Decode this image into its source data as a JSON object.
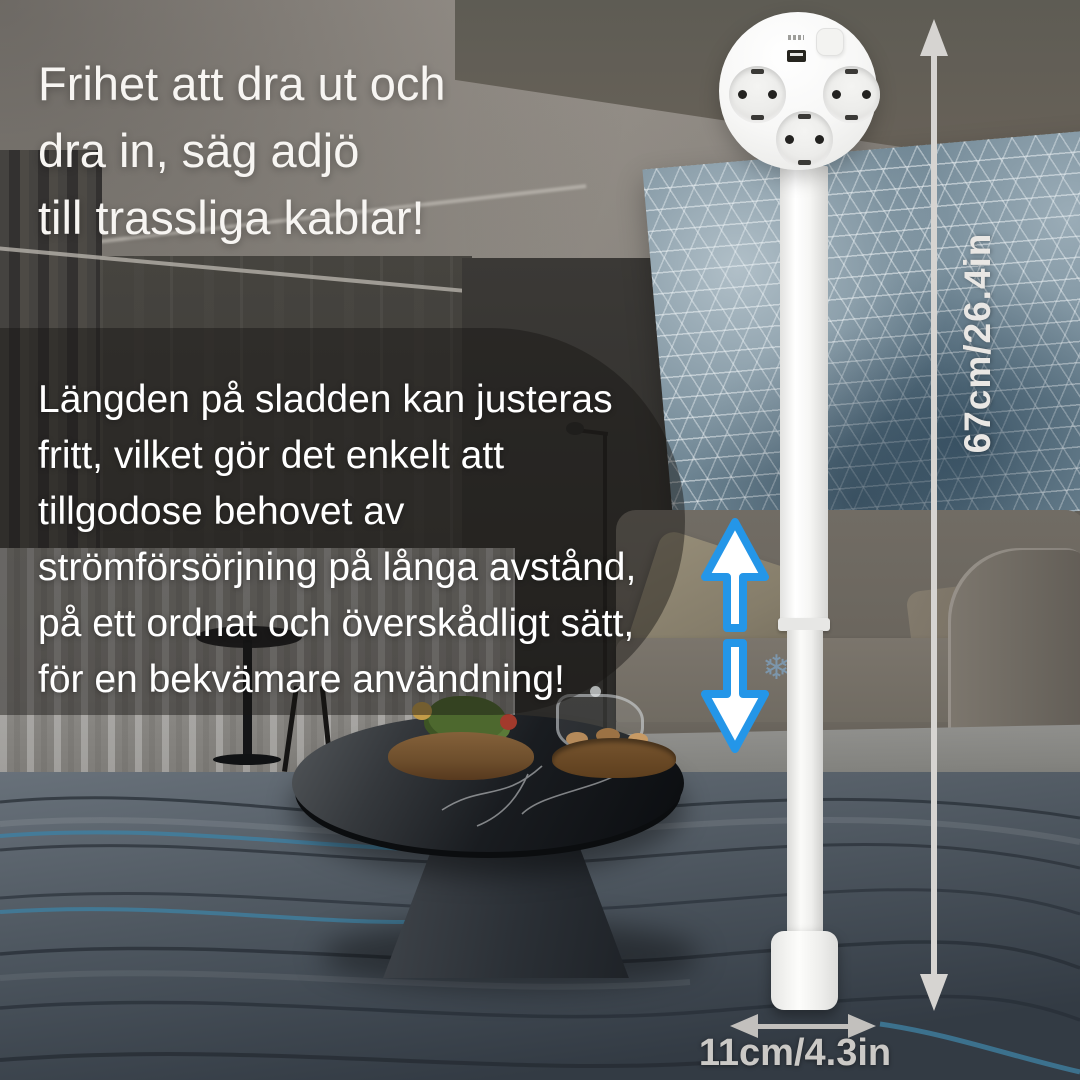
{
  "page": {
    "type": "product-marketing-banner",
    "language": "sv"
  },
  "headline": {
    "text": "Frihet att dra ut och\ndra in, säg adjö\ntill trassliga kablar!"
  },
  "body": {
    "text": "Längden på sladden kan justeras\nfritt, vilket gör det enkelt att\ntillgodose behovet av\nströmförsörjning på långa avstånd,\npå ett ordnat och överskådligt sätt,\nför en bekvämare användning!"
  },
  "dimensions": {
    "height_label": "67cm/26.4in",
    "width_label": "11cm/4.3in"
  },
  "product": {
    "sockets": 3,
    "usb_ports": 1
  },
  "icons": {
    "adjust": "up-down-arrows",
    "height_measure": "double-arrow-vertical",
    "width_measure": "double-arrow-horizontal",
    "snowflake_glyph": "❄"
  },
  "colors": {
    "accent_blue": "#2496e8",
    "measure_gray": "#d6d4d1",
    "text_white": "#ffffff",
    "overlay_dark": "rgba(24,22,20,0.46)",
    "art_blue": "#6e8593",
    "chair_yellow": "#a8822f"
  }
}
